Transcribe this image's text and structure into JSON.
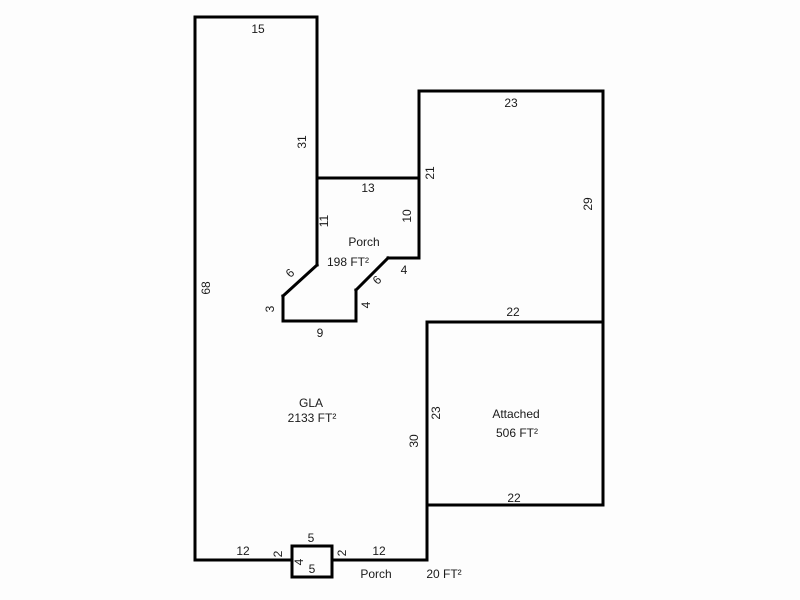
{
  "canvas": {
    "width": 800,
    "height": 600,
    "background_color": "#fdfdfd",
    "wall_color": "#000000",
    "wall_thickness": 3,
    "text_color": "#1a1a1a",
    "font_size_px": 12
  },
  "areas_summary": [
    {
      "name": "GLA",
      "area_text": "2133 FT²"
    },
    {
      "name": "Porch",
      "area_text": "198 FT²"
    },
    {
      "name": "Attached",
      "area_text": "506 FT²"
    },
    {
      "name": "Porch",
      "area_text": "20 FT²"
    }
  ],
  "area_labels": [
    {
      "text": "Porch",
      "x": 364,
      "y": 242,
      "rotate": 0
    },
    {
      "text": "198 FT²",
      "x": 348,
      "y": 262,
      "rotate": 0
    },
    {
      "text": "GLA",
      "x": 311,
      "y": 403,
      "rotate": 0
    },
    {
      "text": "2133 FT²",
      "x": 312,
      "y": 418,
      "rotate": 0
    },
    {
      "text": "Attached",
      "x": 516,
      "y": 414,
      "rotate": 0
    },
    {
      "text": "506 FT²",
      "x": 517,
      "y": 433,
      "rotate": 0
    },
    {
      "text": "Porch",
      "x": 376,
      "y": 574,
      "rotate": 0
    },
    {
      "text": "20 FT²",
      "x": 444,
      "y": 574,
      "rotate": 0
    }
  ],
  "dimension_labels": [
    {
      "text": "15",
      "x": 258,
      "y": 29,
      "rotate": 0
    },
    {
      "text": "68",
      "x": 206,
      "y": 288,
      "rotate": -90
    },
    {
      "text": "31",
      "x": 302,
      "y": 142,
      "rotate": -90
    },
    {
      "text": "11",
      "x": 324,
      "y": 221,
      "rotate": -90
    },
    {
      "text": "13",
      "x": 368,
      "y": 188,
      "rotate": 0
    },
    {
      "text": "21",
      "x": 430,
      "y": 173,
      "rotate": -90
    },
    {
      "text": "10",
      "x": 407,
      "y": 216,
      "rotate": -90
    },
    {
      "text": "23",
      "x": 511,
      "y": 103,
      "rotate": 0
    },
    {
      "text": "29",
      "x": 588,
      "y": 204,
      "rotate": -90
    },
    {
      "text": "4",
      "x": 404,
      "y": 270,
      "rotate": 0
    },
    {
      "text": "6",
      "x": 377,
      "y": 280,
      "rotate": -45
    },
    {
      "text": "4",
      "x": 366,
      "y": 305,
      "rotate": -90
    },
    {
      "text": "6",
      "x": 290,
      "y": 273,
      "rotate": -45
    },
    {
      "text": "3",
      "x": 270,
      "y": 309,
      "rotate": -90
    },
    {
      "text": "9",
      "x": 320,
      "y": 333,
      "rotate": 0
    },
    {
      "text": "22",
      "x": 513,
      "y": 312,
      "rotate": 0
    },
    {
      "text": "23",
      "x": 436,
      "y": 413,
      "rotate": -90
    },
    {
      "text": "30",
      "x": 414,
      "y": 441,
      "rotate": -90
    },
    {
      "text": "22",
      "x": 514,
      "y": 498,
      "rotate": 0
    },
    {
      "text": "12",
      "x": 243,
      "y": 551,
      "rotate": 0
    },
    {
      "text": "2",
      "x": 278,
      "y": 554,
      "rotate": -90
    },
    {
      "text": "5",
      "x": 311,
      "y": 538,
      "rotate": 0
    },
    {
      "text": "4",
      "x": 299,
      "y": 562,
      "rotate": -90
    },
    {
      "text": "5",
      "x": 312,
      "y": 569,
      "rotate": 0
    },
    {
      "text": "2",
      "x": 342,
      "y": 553,
      "rotate": -90
    },
    {
      "text": "12",
      "x": 379,
      "y": 551,
      "rotate": 0
    }
  ],
  "wall_segments": [
    {
      "x1": 195,
      "y1": 17,
      "x2": 317,
      "y2": 17
    },
    {
      "x1": 195,
      "y1": 17,
      "x2": 195,
      "y2": 560
    },
    {
      "x1": 317,
      "y1": 17,
      "x2": 317,
      "y2": 265
    },
    {
      "x1": 317,
      "y1": 178,
      "x2": 419,
      "y2": 178
    },
    {
      "x1": 419,
      "y1": 91,
      "x2": 419,
      "y2": 258
    },
    {
      "x1": 419,
      "y1": 91,
      "x2": 603,
      "y2": 91
    },
    {
      "x1": 603,
      "y1": 91,
      "x2": 603,
      "y2": 505
    },
    {
      "x1": 388,
      "y1": 258,
      "x2": 419,
      "y2": 258
    },
    {
      "x1": 356,
      "y1": 290,
      "x2": 388,
      "y2": 258
    },
    {
      "x1": 356,
      "y1": 290,
      "x2": 356,
      "y2": 321
    },
    {
      "x1": 283,
      "y1": 321,
      "x2": 356,
      "y2": 321
    },
    {
      "x1": 283,
      "y1": 296,
      "x2": 283,
      "y2": 321
    },
    {
      "x1": 283,
      "y1": 296,
      "x2": 317,
      "y2": 265
    },
    {
      "x1": 427,
      "y1": 322,
      "x2": 603,
      "y2": 322
    },
    {
      "x1": 427,
      "y1": 322,
      "x2": 427,
      "y2": 560
    },
    {
      "x1": 427,
      "y1": 505,
      "x2": 603,
      "y2": 505
    },
    {
      "x1": 195,
      "y1": 560,
      "x2": 292,
      "y2": 560
    },
    {
      "x1": 332,
      "y1": 560,
      "x2": 427,
      "y2": 560
    }
  ],
  "stoop_rect": {
    "x": 292,
    "y": 546,
    "width": 40,
    "height": 31
  }
}
